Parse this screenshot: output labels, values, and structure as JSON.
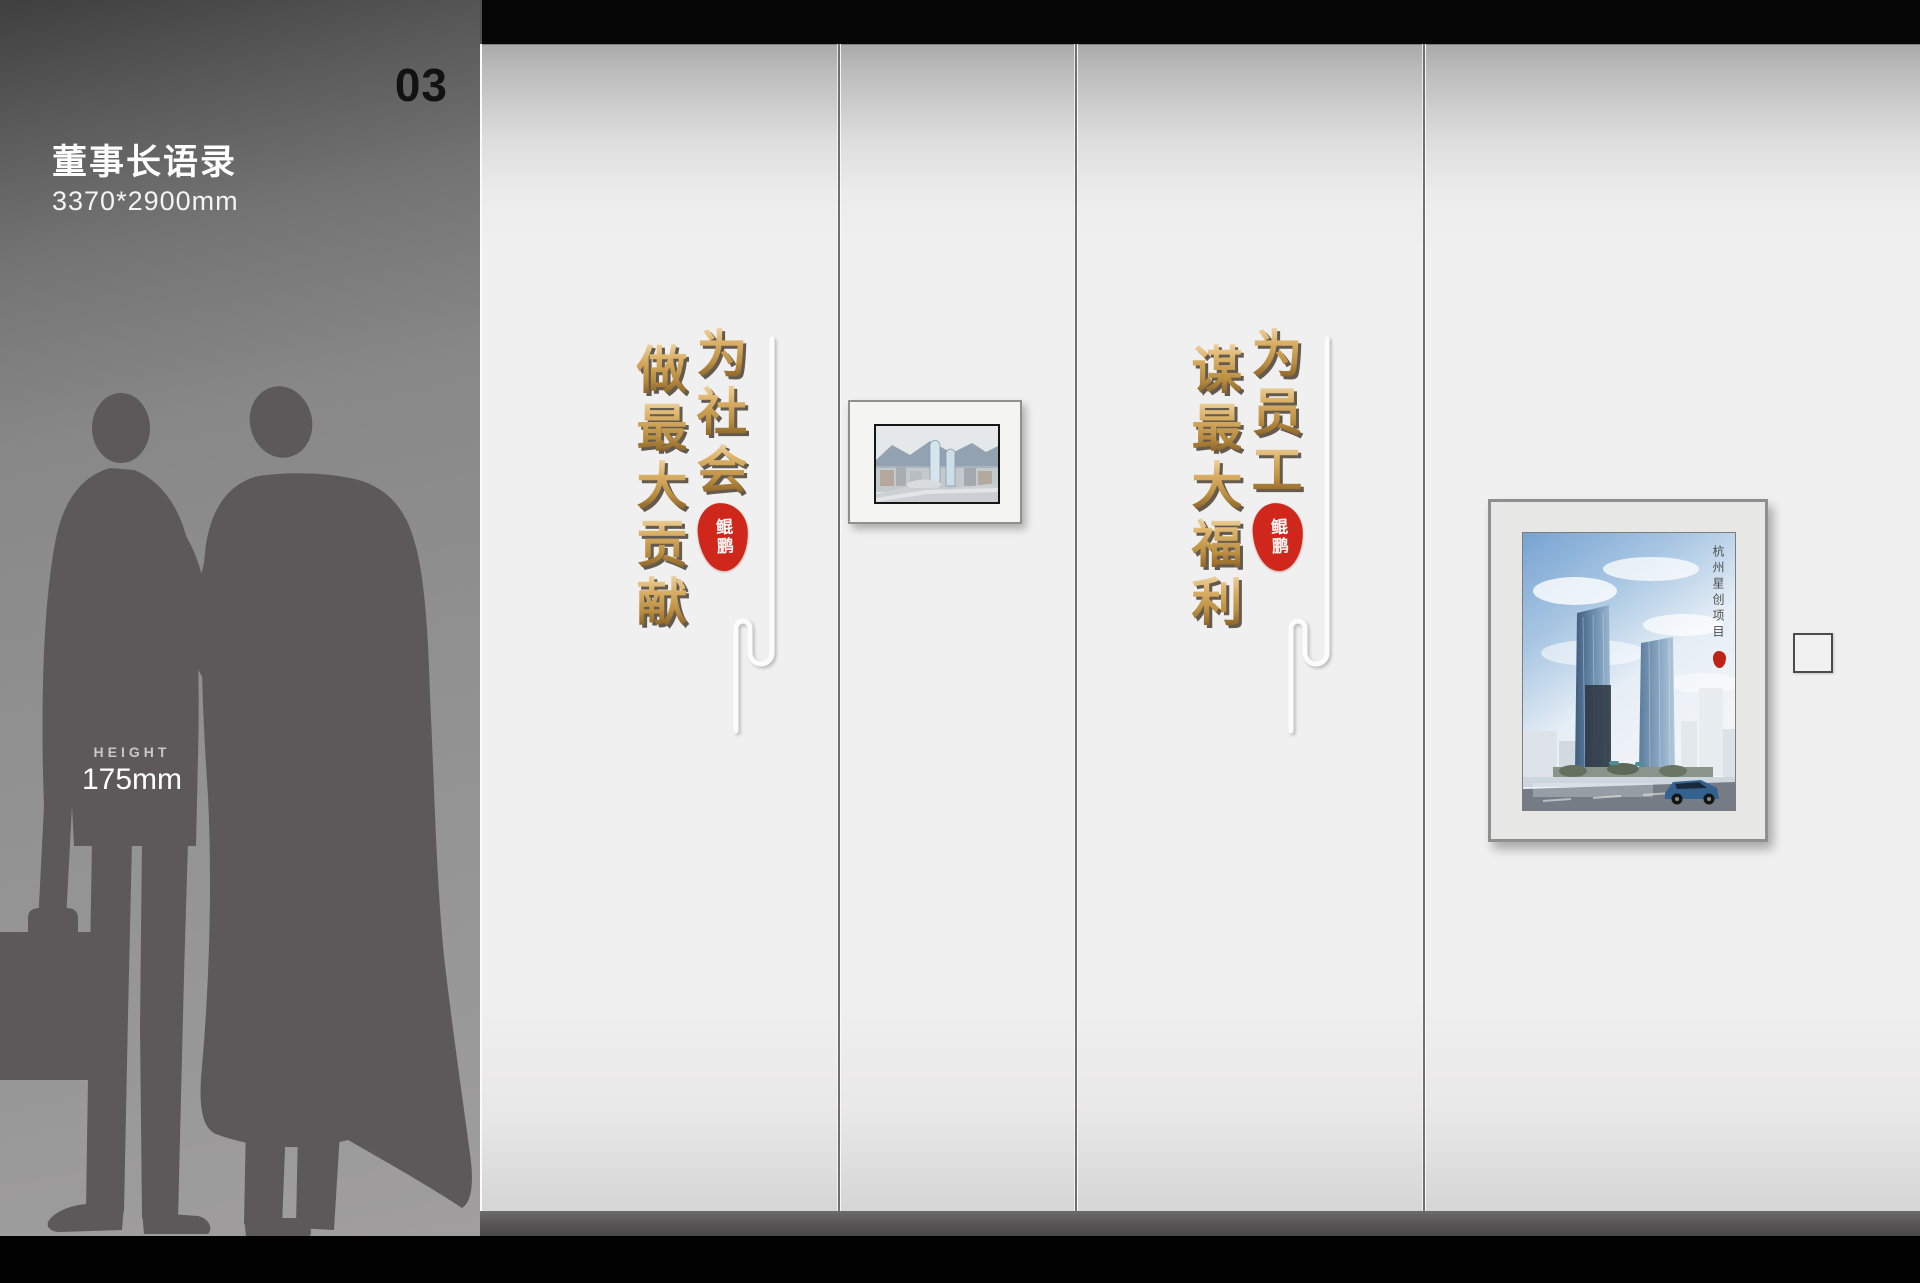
{
  "header": {
    "page_number": "03"
  },
  "sidebar": {
    "title": "董事长语录",
    "dimensions": "3370*2900mm",
    "height_label": "HEIGHT",
    "height_value": "175mm"
  },
  "wall": {
    "quote1": {
      "full": "为社会做最大贡献",
      "col_right": "为社会",
      "col_left": "做最大贡献",
      "seal": "鲲鹏"
    },
    "quote2": {
      "full": "为员工谋最大福利",
      "col_right": "为员工",
      "col_left": "谋最大福利",
      "seal": "鲲鹏"
    },
    "artwork_large_caption": "杭州星创项目"
  },
  "colors": {
    "gold_light": "#eed3a1",
    "gold_dark": "#8f662a",
    "seal_red": "#d0271c",
    "wall_light": "#f1f0f0",
    "sidebar_gray": "#909090",
    "silhouette_gray": "#5d595a",
    "base_bar": "#565354"
  }
}
